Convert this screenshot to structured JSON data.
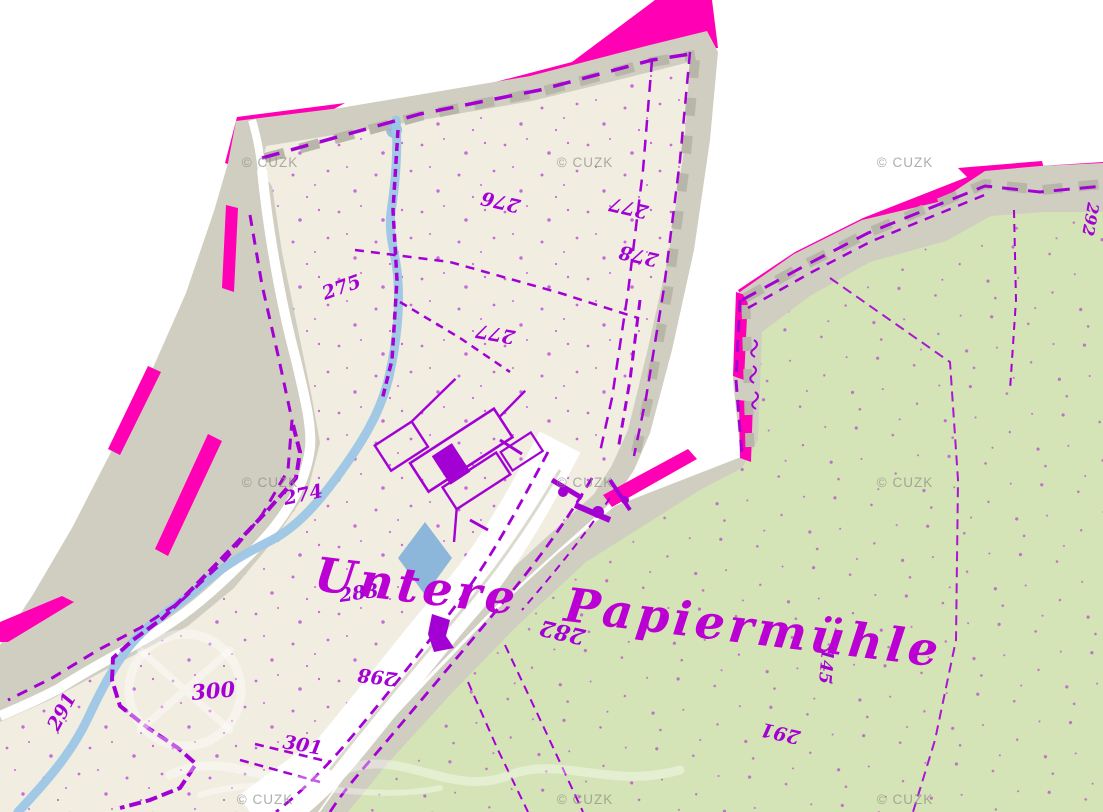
{
  "labels": {
    "title": "Untere Papiermühle",
    "watermark": "© CUZK",
    "parcels": [
      {
        "value": "275"
      },
      {
        "value": "276"
      },
      {
        "value": "277"
      },
      {
        "value": "278"
      },
      {
        "value": "277"
      },
      {
        "value": "274"
      },
      {
        "value": "283"
      },
      {
        "value": "282"
      },
      {
        "value": "298"
      },
      {
        "value": "300"
      },
      {
        "value": "301"
      },
      {
        "value": "291"
      },
      {
        "value": "291"
      },
      {
        "value": "145"
      },
      {
        "value": "292"
      }
    ]
  },
  "colors": {
    "background": "#ffffff",
    "sheet_border": "#d0cec1",
    "sheet_border_dark": "#b8b6a8",
    "sheet1_paper": "#f1eee1",
    "sheet2_paper": "#d5e4b6",
    "highlight_magenta": "#ff00b4",
    "linework_purple": "#a300d4",
    "title_purple": "#bb00d4",
    "water_blue": "#9cc6e6",
    "symbol_blue": "#8cb6da",
    "watermark_gray": "#8e8e88"
  }
}
